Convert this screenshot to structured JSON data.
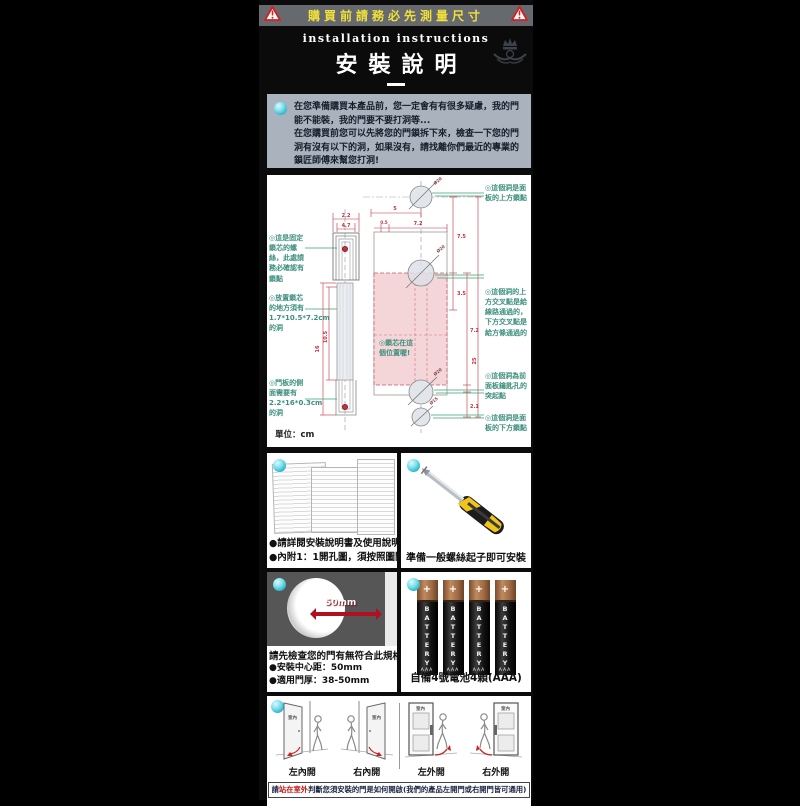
{
  "banner": {
    "text": "購買前請務必先測量尺寸"
  },
  "header": {
    "subtitle": "installation instructions",
    "title": "安裝說明"
  },
  "intro": {
    "text": "在您準備購買本產品前，您一定會有有很多疑慮，我的門\n能不能裝，我的門要不要打洞等...\n在您購買前您可以先將您的門鎖拆下來，檢查一下您的門\n洞有沒有以下的洞，如果沒有，請找離你們最近的專業的\n鎖匠師傅來幫您打洞!"
  },
  "diagram": {
    "unit_label": "單位：cm",
    "left_labels": [
      "◎這是固定鎖芯的螺絲，此處請務必確認有鎖點",
      "◎放置鎖芯的地方須有1.7*10.5*7.2cm的洞",
      "◎門板的側面需要有2.2*16*0.3cm的洞"
    ],
    "center_label": "◎鎖芯在這個位置喔!",
    "right_labels": [
      "◎這個洞是面板的上方鎖點",
      "◎這個洞的上方交叉點是給線路通過的，下方交叉點是給方條通過的",
      "◎這個洞為前面板鑰匙孔的突起點",
      "◎這個洞是面板的下方鎖點"
    ],
    "dims": {
      "top_w": "2.2",
      "top_inner": "4.7",
      "span5": "5",
      "gap05": "0.5",
      "w72": "7.2",
      "h16": "16",
      "h105": "10.5",
      "r75": "7.5",
      "r35": "3.5",
      "r72": "7.2",
      "r21": "2.1",
      "total": "25",
      "dia_top": "Ø20",
      "dia_mid": "Ø20",
      "dia_b1": "Ø20",
      "dia_b2": "Ø15"
    }
  },
  "manual_section": {
    "bullet1": "●請詳閱安裝說明書及使用說明書",
    "bullet2": "●內附1：1開孔圖，須按照圖開孔"
  },
  "screwdriver_section": {
    "caption": "準備一般螺絲起子即可安裝"
  },
  "hole_section": {
    "arrow_label": "50mm",
    "title": "請先檢查您的門有無符合此規格",
    "bullet1": "●安裝中心距：50mm",
    "bullet2": "●適用門厚：38-50mm"
  },
  "battery_section": {
    "caption": "自備4號電池4顆(AAA)",
    "brand": "BATTERY",
    "size": "AAA",
    "plus": "+"
  },
  "doors_section": {
    "room_label": "室內",
    "labels": [
      "左內開",
      "右內開",
      "左外開",
      "右外開"
    ],
    "caption": {
      "pre": "請",
      "highlight": "站在室外",
      "post": "判斷您須安裝的門是如何開啟(我們的產品左開門或右開門皆可通用)"
    }
  },
  "colors": {
    "banner_yellow": "#f1e13b",
    "accent_red": "#c2303f",
    "leader_green": "#3aa271",
    "pink_zone": "#f4d5d8",
    "cyan_bullet": "#49c6d8",
    "label_teal": "#3c8f7d"
  }
}
